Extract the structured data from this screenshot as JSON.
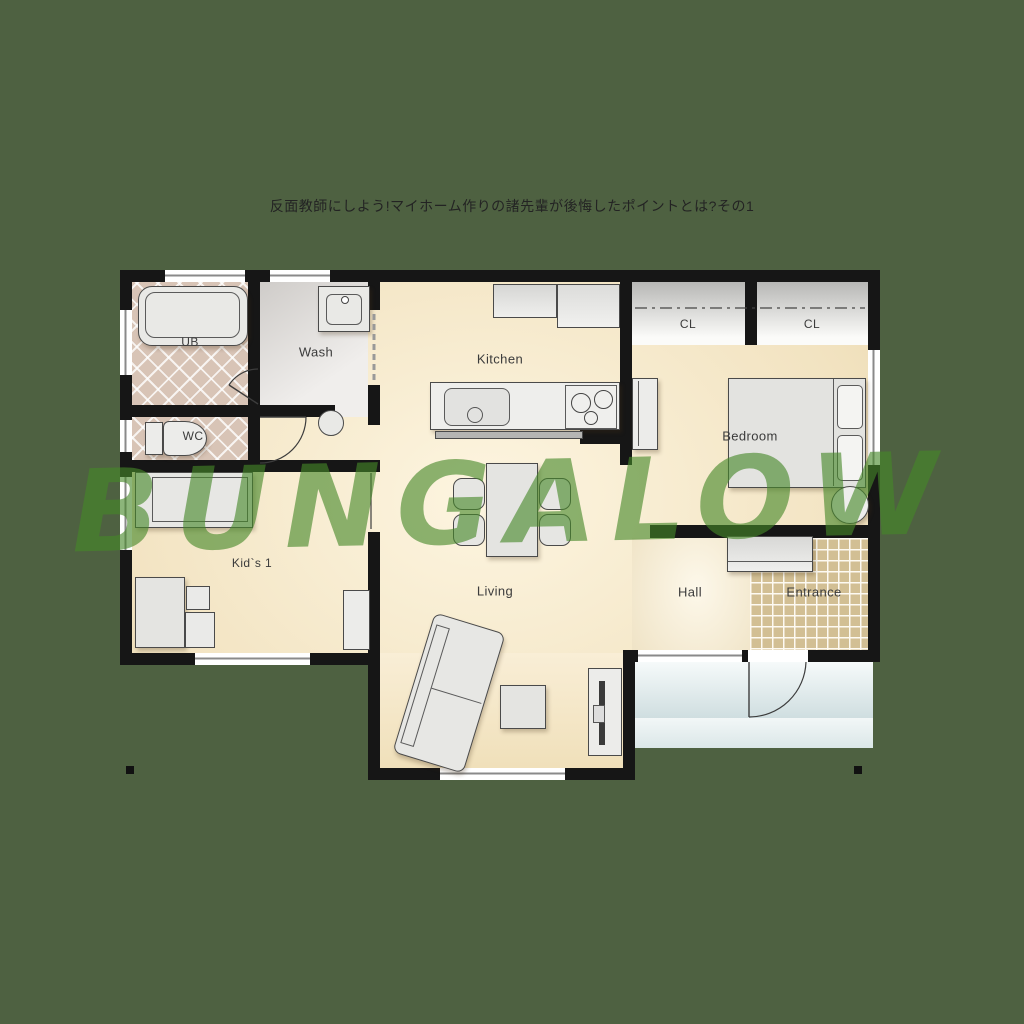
{
  "header": {
    "title": "反面教師にしよう!マイホーム作りの諸先輩が後悔したポイントとは?その1"
  },
  "watermark": {
    "text": "BUNGALOW",
    "color": "#4a8728"
  },
  "colors": {
    "background": "#4e6141",
    "wall": "#161616",
    "wood_floor": "#f3e4c2",
    "bath_tile": "#d8c4b6",
    "entrance_tile": "#d2bf94",
    "porch": "#dde9ea",
    "furniture": "#e6e6e3",
    "label_text": "#3b3b3b"
  },
  "rooms": [
    {
      "label": "UB"
    },
    {
      "label": "Wash"
    },
    {
      "label": "Kitchen"
    },
    {
      "label": "CL"
    },
    {
      "label": "CL"
    },
    {
      "label": "Bedroom"
    },
    {
      "label": "WC"
    },
    {
      "label": "Kid`s 1"
    },
    {
      "label": "Living"
    },
    {
      "label": "Hall"
    },
    {
      "label": "Entrance"
    }
  ]
}
